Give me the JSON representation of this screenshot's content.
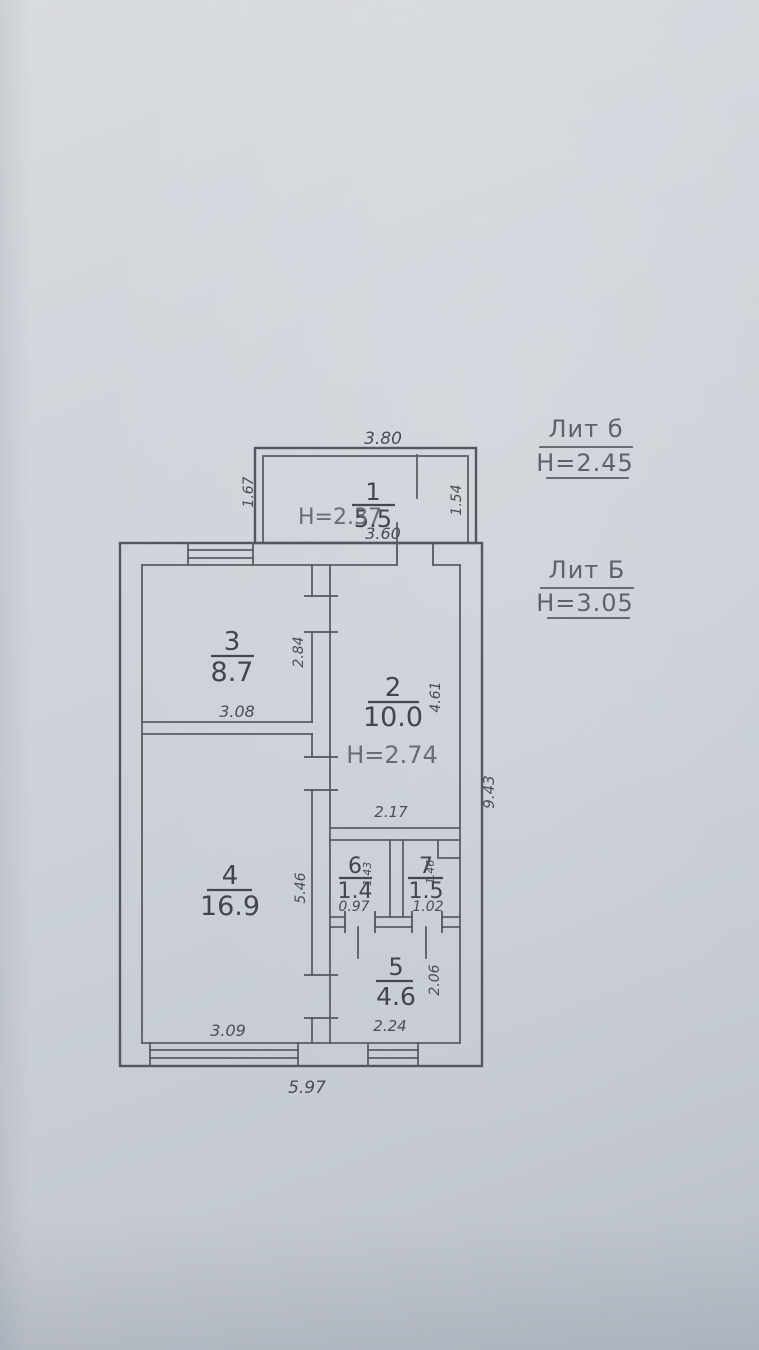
{
  "legend": {
    "upper": {
      "label": "Лит б",
      "height": "H=2.45"
    },
    "lower": {
      "label": "Лит Б",
      "height": "H=3.05"
    }
  },
  "overall_dims": {
    "right": "9.43",
    "bottom": "5.97"
  },
  "rooms": {
    "r1": {
      "number": "1",
      "area": "5.5",
      "height_note": "H=2.37",
      "dims": {
        "top": "3.80",
        "left": "1.67",
        "right": "1.54",
        "bottom": "3.60"
      }
    },
    "r2": {
      "number": "2",
      "area": "10.0",
      "height_note": "H=2.74",
      "dims": {
        "right": "4.61",
        "bottom": "2.17"
      }
    },
    "r3": {
      "number": "3",
      "area": "8.7",
      "dims": {
        "right": "2.84",
        "bottom": "3.08"
      }
    },
    "r4": {
      "number": "4",
      "area": "16.9",
      "dims": {
        "right": "5.46",
        "bottom": "3.09"
      }
    },
    "r5": {
      "number": "5",
      "area": "4.6",
      "dims": {
        "right": "2.06",
        "bottom": "2.24"
      }
    },
    "r6": {
      "number": "6",
      "area": "1.4",
      "dims": {
        "right": "1.43",
        "bottom": "0.97"
      }
    },
    "r7": {
      "number": "7",
      "area": "1.5",
      "dims": {
        "right": "1.46",
        "bottom": "1.02"
      }
    }
  }
}
